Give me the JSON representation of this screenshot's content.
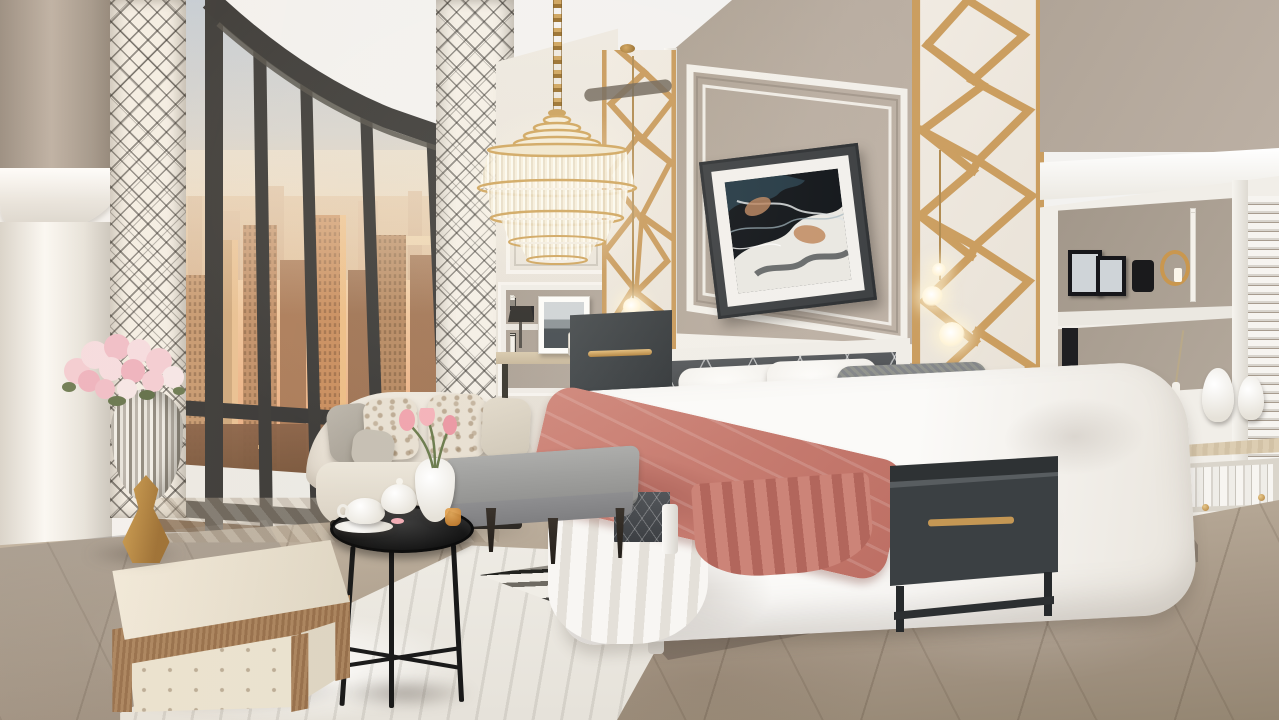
{
  "scene": {
    "type": "natural-image-3d-render",
    "subject": "Luxury high-rise bedroom interior at sunset",
    "view": "City skyline seen through curved floor-to-ceiling windows",
    "objects": [
      "crystal chandelier with gold chain",
      "gold geometric fretwork wall panels",
      "framed abstract marbled artwork",
      "bed with charcoal tufted crystal headboard",
      "white duvet with coral throw blanket",
      "white and gray accent pillows",
      "curved cream sofa with damask pillows",
      "gray upholstered bench",
      "black round tray table with tea set and tulips",
      "wood-trimmed cream tufted ottoman",
      "silver vase with pink roses on gold base",
      "charcoal nightstands with brass handles",
      "built-in white bookcases and sideboard",
      "black and white striped area rug",
      "marble tile floor",
      "glowing pendant globe lights",
      "diamond trellis curtains",
      "white column with capital"
    ]
  },
  "palette": {
    "wall_taupe": "#b3a79c",
    "molding_white": "#f2efe9",
    "gold_accent": "#c89a5c",
    "window_frame": "#3a3938",
    "sky_top": "#c6ced6",
    "sky_horizon": "#f2cda4",
    "city_warm": "#c98e5f",
    "floor_taupe": "#b6a896",
    "rug_cream": "#f0ede6",
    "rug_stripe_black": "#2c2c2a",
    "bedding_white": "#faf8f5",
    "throw_coral": "#c87f74",
    "headboard_charcoal": "#46494c",
    "nightstand_charcoal": "#3c4144",
    "sofa_cream": "#ece6da",
    "bench_gray": "#98989a",
    "ottoman_cream": "#ece4d2",
    "ottoman_wood": "#a07b55",
    "flowers_pink": "#f0bfc9"
  },
  "labels": {
    "book_spine_fine_wines": "FINE WINES",
    "book_spine_piano": "Man and Piano"
  }
}
